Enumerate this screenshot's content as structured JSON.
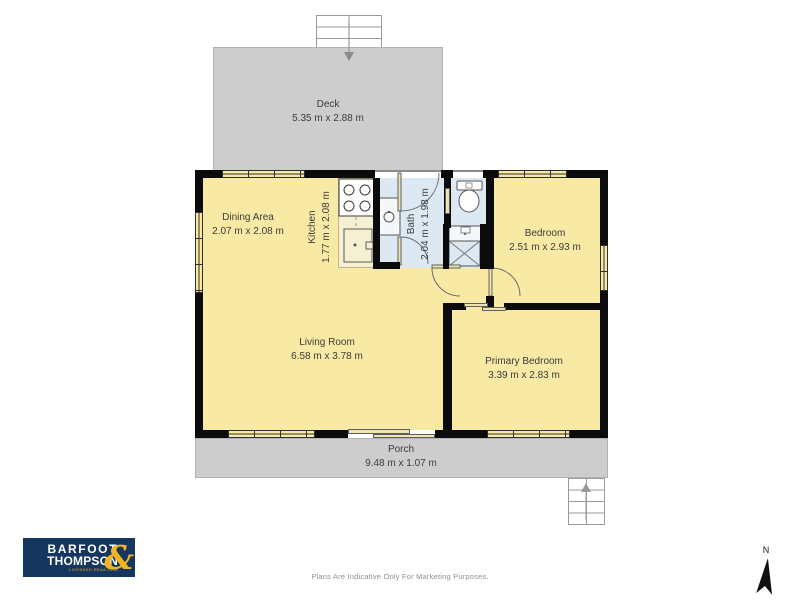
{
  "rooms": {
    "deck": {
      "name": "Deck",
      "dims": "5.35 m x 2.88 m"
    },
    "dining": {
      "name": "Dining Area",
      "dims": "2.07 m x 2.08 m"
    },
    "kitchen": {
      "name": "Kitchen",
      "dims": "1.77 m x 2.08 m"
    },
    "bath": {
      "name": "Bath",
      "dims": "2.04 m x 1.98 m"
    },
    "bedroom": {
      "name": "Bedroom",
      "dims": "2.51 m x 2.93 m"
    },
    "living": {
      "name": "Living Room",
      "dims": "6.58 m x 3.78 m"
    },
    "primary": {
      "name": "Primary Bedroom",
      "dims": "3.39 m x 2.83 m"
    },
    "porch": {
      "name": "Porch",
      "dims": "9.48 m x 1.07 m"
    }
  },
  "branding": {
    "brand_line1": "BARFOOT",
    "brand_amp": "&",
    "brand_line2": "THOMPSON",
    "brand_tagline": "LICENSED REAA 2008"
  },
  "footer": {
    "disclaimer": "Plans Are Indicative Only For Marketing Purposes."
  },
  "compass": {
    "north_label": "N"
  },
  "colors": {
    "room_fill": "#F8E9A4",
    "wet_room_fill": "#DCE9F2",
    "outdoor_fill": "#CDCDCD",
    "wall": "#0B0B0B",
    "logo_navy": "#14365F",
    "logo_gold": "#F2B420"
  }
}
